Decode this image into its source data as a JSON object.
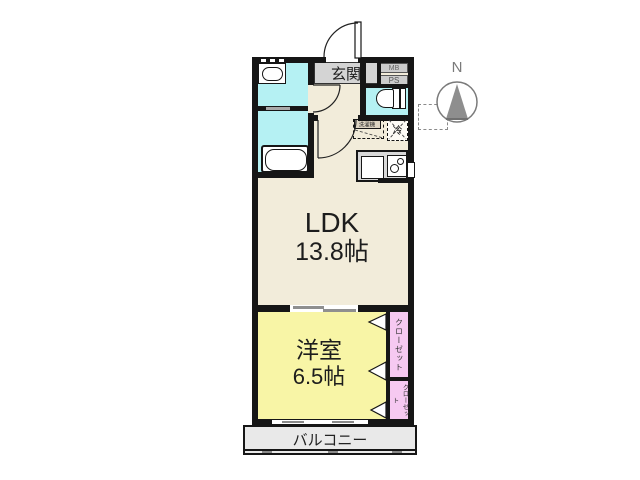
{
  "compass": {
    "north": "N"
  },
  "rooms": {
    "ldk": {
      "name": "LDK",
      "size": "13.8帖"
    },
    "western": {
      "name": "洋室",
      "size": "6.5帖"
    },
    "balcony": {
      "name": "バルコニー"
    },
    "entrance": {
      "name": "玄関"
    },
    "closet_upper": {
      "label": "クローゼット"
    },
    "closet_lower": {
      "label": "クローゼット"
    }
  },
  "equipment": {
    "meter_box": "MB",
    "pipe_space": "PS",
    "refrigerator": "冷",
    "washing_machine": "洗濯機"
  },
  "colors": {
    "room_beige": "#f2ecda",
    "wet_area_cyan": "#b5f1f3",
    "western_yellow": "#f8f5a6",
    "closet_pink": "#f6c9f1",
    "service_gray": "#d7d7d7",
    "wall_black": "#161616"
  }
}
